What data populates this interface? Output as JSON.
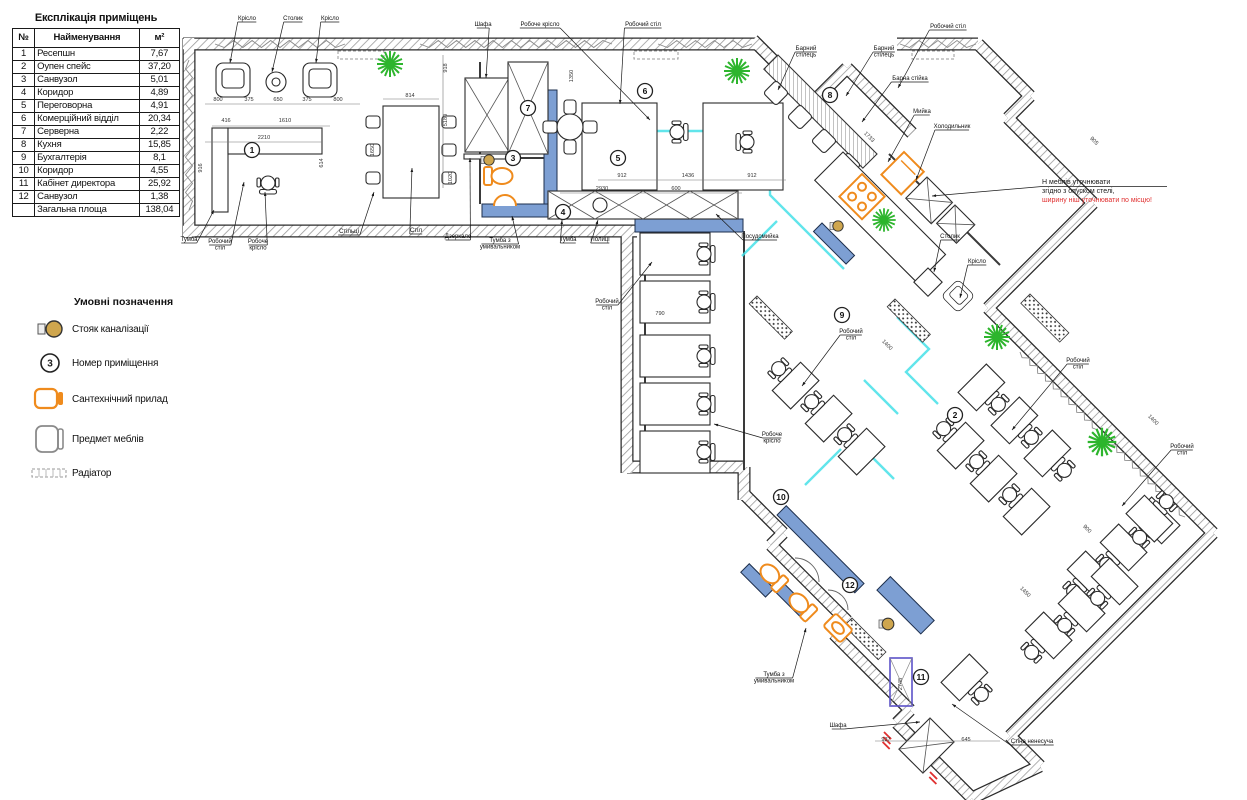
{
  "explication": {
    "title": "Експлікація приміщень",
    "columns": [
      "№",
      "Найменування",
      "м²"
    ],
    "rows": [
      {
        "n": "1",
        "name": "Ресепшн",
        "area": "7,67"
      },
      {
        "n": "2",
        "name": "Оупен спейс",
        "area": "37,20"
      },
      {
        "n": "3",
        "name": "Санвузол",
        "area": "5,01"
      },
      {
        "n": "4",
        "name": "Коридор",
        "area": "4,89"
      },
      {
        "n": "5",
        "name": "Переговорна",
        "area": "4,91"
      },
      {
        "n": "6",
        "name": "Комерційний відділ",
        "area": "20,34"
      },
      {
        "n": "7",
        "name": "Серверна",
        "area": "2,22"
      },
      {
        "n": "8",
        "name": "Кухня",
        "area": "15,85"
      },
      {
        "n": "9",
        "name": "Бухгалтерія",
        "area": "8,1"
      },
      {
        "n": "10",
        "name": "Коридор",
        "area": "4,55"
      },
      {
        "n": "11",
        "name": "Кабінет директора",
        "area": "25,92"
      },
      {
        "n": "12",
        "name": "Санвузол",
        "area": "1,38"
      },
      {
        "n": "",
        "name": "Загальна площа",
        "area": "138,04"
      }
    ]
  },
  "legend": {
    "title": "Умовні позначення",
    "items": [
      {
        "icon": "sewer-riser-icon",
        "label": "Стояк каналізації"
      },
      {
        "icon": "room-number-icon",
        "label": "Номер приміщення",
        "symbol_text": "3"
      },
      {
        "icon": "plumbing-fixture-icon",
        "label": "Сантехнічний прилад"
      },
      {
        "icon": "furniture-icon",
        "label": "Предмет меблів"
      },
      {
        "icon": "radiator-icon",
        "label": "Радіатор"
      }
    ]
  },
  "plan": {
    "colors": {
      "wall_hatch": "#9a9a9a",
      "wall_casing": "#2a2a2a",
      "blue_wall": "#7d9fd3",
      "glass": "#45e0e8",
      "fixture": "#ef8b1d",
      "plant": "#2db52d",
      "riser": "#cfa64e",
      "shaft": "#5b51c8",
      "note_red": "#e03030"
    },
    "note": {
      "x": 1042,
      "y": 184,
      "tx": 932,
      "ty": 196,
      "lines": [
        {
          "text": "Н меблів уточнювати",
          "color": "#1a1a1a"
        },
        {
          "text": "згідно з опуском стелі,",
          "color": "#1a1a1a"
        },
        {
          "text": "ширину ніш уточнювати по місцю!",
          "color": "#e03030"
        }
      ]
    },
    "labels": [
      {
        "t": "Крісло",
        "x": 247,
        "y": 20,
        "tx": 230,
        "ty": 63
      },
      {
        "t": "Столик",
        "x": 293,
        "y": 20,
        "tx": 272,
        "ty": 72
      },
      {
        "t": "Крісло",
        "x": 330,
        "y": 20,
        "tx": 316,
        "ty": 63
      },
      {
        "t": "Шафа",
        "x": 483,
        "y": 26,
        "tx": 486,
        "ty": 78
      },
      {
        "t": "Робоче крісло",
        "x": 540,
        "y": 26,
        "tx": 650,
        "ty": 120
      },
      {
        "t": "Робочий стіл",
        "x": 643,
        "y": 26,
        "tx": 620,
        "ty": 104
      },
      {
        "t": "Робочий стіл",
        "x": 948,
        "y": 28,
        "tx": 898,
        "ty": 88
      },
      {
        "t": "Барний|стілець",
        "x": 806,
        "y": 50,
        "tx": 778,
        "ty": 90
      },
      {
        "t": "Барний|стілець",
        "x": 884,
        "y": 50,
        "tx": 846,
        "ty": 96
      },
      {
        "t": "Барна стійка",
        "x": 910,
        "y": 80,
        "tx": 862,
        "ty": 122
      },
      {
        "t": "Мийка",
        "x": 922,
        "y": 113,
        "tx": 888,
        "ty": 162
      },
      {
        "t": "Холодильник",
        "x": 952,
        "y": 128,
        "tx": 916,
        "ty": 180
      },
      {
        "t": "Столик",
        "x": 950,
        "y": 238,
        "tx": 934,
        "ty": 272
      },
      {
        "t": "Крісло",
        "x": 977,
        "y": 263,
        "tx": 960,
        "ty": 298
      },
      {
        "t": "Тумба",
        "x": 189,
        "y": 241,
        "tx": 214,
        "ty": 210
      },
      {
        "t": "Робочий|стіл",
        "x": 220,
        "y": 243,
        "tx": 244,
        "ty": 182
      },
      {
        "t": "Робоче|крісло",
        "x": 258,
        "y": 243,
        "tx": 265,
        "ty": 192
      },
      {
        "t": "Стільці",
        "x": 349,
        "y": 233,
        "tx": 374,
        "ty": 192
      },
      {
        "t": "Стіл",
        "x": 416,
        "y": 232,
        "tx": 412,
        "ty": 168
      },
      {
        "t": "Дзеркало",
        "x": 458,
        "y": 238,
        "tx": 470,
        "ty": 158
      },
      {
        "t": "Тумба з|умивальником",
        "x": 500,
        "y": 242,
        "tx": 512,
        "ty": 216
      },
      {
        "t": "Тумба",
        "x": 568,
        "y": 241,
        "tx": 562,
        "ty": 220
      },
      {
        "t": "Полиці",
        "x": 600,
        "y": 241,
        "tx": 598,
        "ty": 220
      },
      {
        "t": "Посудомийка",
        "x": 760,
        "y": 238,
        "tx": 716,
        "ty": 214
      },
      {
        "t": "Робочий|стіл",
        "x": 607,
        "y": 303,
        "tx": 652,
        "ty": 262
      },
      {
        "t": "Робочий|стіл",
        "x": 851,
        "y": 333,
        "tx": 802,
        "ty": 386
      },
      {
        "t": "Робоче|крісло",
        "x": 772,
        "y": 436,
        "tx": 714,
        "ty": 424
      },
      {
        "t": "Робочий|стіл",
        "x": 1078,
        "y": 362,
        "tx": 1012,
        "ty": 430
      },
      {
        "t": "Робочий|стіл",
        "x": 1182,
        "y": 448,
        "tx": 1122,
        "ty": 506
      },
      {
        "t": "Тумба з|умивальником",
        "x": 774,
        "y": 676,
        "tx": 806,
        "ty": 628
      },
      {
        "t": "Шафа",
        "x": 838,
        "y": 727,
        "tx": 920,
        "ty": 722
      },
      {
        "t": "Стіна ненесуча",
        "x": 1032,
        "y": 743,
        "tx": 952,
        "ty": 704
      }
    ],
    "dims": [
      {
        "t": "800",
        "x": 218,
        "y": 101
      },
      {
        "t": "375",
        "x": 249,
        "y": 101
      },
      {
        "t": "650",
        "x": 278,
        "y": 101
      },
      {
        "t": "375",
        "x": 307,
        "y": 101
      },
      {
        "t": "800",
        "x": 338,
        "y": 101
      },
      {
        "t": "416",
        "x": 226,
        "y": 122
      },
      {
        "t": "1610",
        "x": 285,
        "y": 122
      },
      {
        "t": "2210",
        "x": 264,
        "y": 139
      },
      {
        "t": "916",
        "x": 202,
        "y": 168,
        "r": -90
      },
      {
        "t": "614",
        "x": 323,
        "y": 163,
        "r": -90
      },
      {
        "t": "814",
        "x": 410,
        "y": 97
      },
      {
        "t": "1650",
        "x": 374,
        "y": 150,
        "r": -90
      },
      {
        "t": "1350",
        "x": 573,
        "y": 76,
        "r": -90
      },
      {
        "t": "918",
        "x": 447,
        "y": 68,
        "r": -90
      },
      {
        "t": "5180",
        "x": 447,
        "y": 120,
        "r": -90
      },
      {
        "t": "1020",
        "x": 452,
        "y": 178,
        "r": -90
      },
      {
        "t": "912",
        "x": 622,
        "y": 177
      },
      {
        "t": "1436",
        "x": 688,
        "y": 177
      },
      {
        "t": "912",
        "x": 752,
        "y": 177
      },
      {
        "t": "2930",
        "x": 602,
        "y": 190
      },
      {
        "t": "600",
        "x": 676,
        "y": 190
      },
      {
        "t": "790",
        "x": 660,
        "y": 315
      },
      {
        "t": "1733",
        "x": 868,
        "y": 138,
        "r": 45
      },
      {
        "t": "905",
        "x": 1093,
        "y": 142,
        "r": 45
      },
      {
        "t": "1400",
        "x": 886,
        "y": 346,
        "r": 45
      },
      {
        "t": "1400",
        "x": 1152,
        "y": 421,
        "r": 45
      },
      {
        "t": "900",
        "x": 1086,
        "y": 530,
        "r": 45
      },
      {
        "t": "1450",
        "x": 1024,
        "y": 593,
        "r": 45
      },
      {
        "t": "937",
        "x": 886,
        "y": 741
      },
      {
        "t": "645",
        "x": 966,
        "y": 741
      },
      {
        "t": "2745",
        "x": 902,
        "y": 684,
        "r": -90
      }
    ],
    "rooms": [
      {
        "n": "1",
        "x": 252,
        "y": 150
      },
      {
        "n": "2",
        "x": 955,
        "y": 415
      },
      {
        "n": "3",
        "x": 513,
        "y": 158
      },
      {
        "n": "4",
        "x": 563,
        "y": 212
      },
      {
        "n": "5",
        "x": 618,
        "y": 158
      },
      {
        "n": "6",
        "x": 645,
        "y": 91
      },
      {
        "n": "7",
        "x": 528,
        "y": 108
      },
      {
        "n": "8",
        "x": 830,
        "y": 95
      },
      {
        "n": "9",
        "x": 842,
        "y": 315
      },
      {
        "n": "10",
        "x": 781,
        "y": 497
      },
      {
        "n": "11",
        "x": 921,
        "y": 677
      },
      {
        "n": "12",
        "x": 850,
        "y": 585
      }
    ]
  }
}
